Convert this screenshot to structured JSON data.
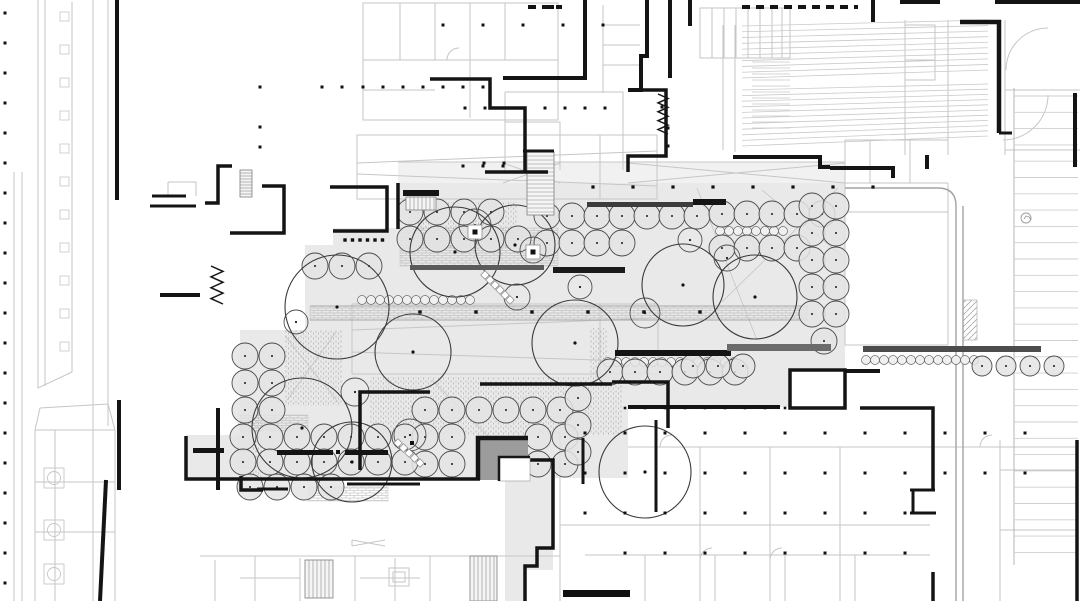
{
  "meta": {
    "drawing_type": "architectural-site-plan",
    "canvas_w": 1080,
    "canvas_h": 601
  },
  "palette": {
    "background": "#ffffff",
    "plaza_fill": "#e9e9e9",
    "corridor_fill": "#f1f1f1",
    "light_line": "#c6c6c6",
    "mid_line": "#a3a3a3",
    "dark_line": "#141414",
    "tree_line": "#4a4a4a",
    "tree_fill": "#e4e4e4",
    "shrub_line": "#6a6a6a",
    "shrub_fill": "#f0f0f0",
    "big_tree_line": "#3a3a3a",
    "roof_gray": "#9c9c9c",
    "hatch_line": "#a0a0a0",
    "bench_dark": "#141414",
    "bench_gray": "#6b6b6b"
  },
  "plan": {
    "plaza_polygon": "398,183 845,183 845,368 790,368 790,407 628,407 628,478 553,478 553,570 525,570 525,601 505,601 505,480 240,480 240,330 305,330 305,245 333,245 333,228 398,228",
    "plaza_extra_rect": [
      186,
      435,
      54,
      45
    ],
    "corridor_rect": [
      398,
      162,
      447,
      21
    ],
    "gray_square": [
      478,
      438,
      50,
      42
    ],
    "white_inset": [
      499,
      457,
      31,
      24
    ],
    "inset_border": "M499,481 V457 H530",
    "square_border": "M478,480 V438 H528",
    "band_lines": "M310,306 H808 M310,320 H808",
    "brick_rects": [
      [
        400,
        228,
        158,
        38
      ],
      [
        310,
        306,
        498,
        14
      ],
      [
        240,
        415,
        68,
        16
      ],
      [
        308,
        487,
        80,
        14
      ]
    ],
    "stipple_rects": [
      [
        285,
        330,
        58,
        76
      ],
      [
        370,
        377,
        252,
        58
      ],
      [
        590,
        328,
        18,
        52
      ],
      [
        237,
        400,
        26,
        82
      ],
      [
        405,
        202,
        112,
        46
      ]
    ],
    "diag_rects": [
      [
        963,
        300,
        14,
        40
      ]
    ],
    "wall_paths": [
      [
        "M117,0 V200",
        4
      ],
      [
        "M585,0 V78 H503",
        4
      ],
      [
        "M430,79 H490 V108 H525 V172",
        3.5
      ],
      [
        "M485,172 H548",
        3.5
      ],
      [
        "M647,0 V56 H641 V90 H628",
        4
      ],
      [
        "M670,0 V78",
        4
      ],
      [
        "M690,0 V26",
        4
      ],
      [
        "M628,90 H666 V156 H628 V172",
        3.5
      ],
      [
        "M960,22 H999 V133",
        4.5
      ],
      [
        "M999,133 H1012",
        3
      ],
      [
        "M873,0 V22",
        4
      ],
      [
        "M733,157 H820 V167 H830",
        4
      ],
      [
        "M830,168 H893 V178",
        4
      ],
      [
        "M927,155 V169",
        4
      ],
      [
        "M1075,93 V167",
        4
      ],
      [
        "M995,2 H1080",
        4
      ],
      [
        "M900,2 H940",
        4
      ],
      [
        "M205,203 H218 V166 H232",
        3.5
      ],
      [
        "M230,233 H284 V186 H262",
        3.5
      ],
      [
        "M330,187 H387 V231 H333",
        3.5
      ],
      [
        "M152,196 H186",
        3
      ],
      [
        "M150,206 H196",
        3
      ],
      [
        "M160,295 H200",
        4
      ],
      [
        "M398,183 V229",
        3.5
      ],
      [
        "M523,151 H554",
        3
      ],
      [
        "M360,470 V392 H430",
        3.5
      ],
      [
        "M480,384 H612",
        3.5
      ],
      [
        "M612,382 H668 V428",
        3.5
      ],
      [
        "M656,420 V512",
        3
      ],
      [
        "M186,436 V479 H480",
        3.5
      ],
      [
        "M347,484 H420",
        3
      ],
      [
        "M583,438 V484",
        3
      ],
      [
        "M628,407 H780",
        4
      ],
      [
        "M790,408 V370 H845 V408 Z",
        3.5
      ],
      [
        "M845,371 H880",
        4
      ],
      [
        "M860,408 H933 V490",
        3.5
      ],
      [
        "M910,490 H935",
        3
      ],
      [
        "M913,490 V513",
        3
      ],
      [
        "M910,513 H936",
        3
      ],
      [
        "M933,572 V601",
        3.5
      ],
      [
        "M1077,440 V601",
        3.5
      ],
      [
        "M119,400 V490",
        4
      ],
      [
        "M218,408 V490",
        4
      ],
      [
        "M106,480 L100,601",
        4
      ],
      [
        "M241,476 V490 H263",
        3.5
      ],
      [
        "M257,489 H288",
        3
      ],
      [
        "M515,460 H553 V548 H537 V566 H525 V601",
        3.5
      ]
    ],
    "dashed_walls": [
      [
        "M742,7 H858",
        4
      ],
      [
        "M528,7 H562",
        4
      ]
    ],
    "light_paths": [
      "M38,0 V388 L72,372 V2 M45,0 V386",
      "M93,0 V601 M108,0 V426 M14,172 V601 M22,172 V601",
      "M363,3 H558 V120 H363 Z M400,3 V60 M435,3 V60 M470,3 V118 M505,3 V60 M363,60 H558 M363,90 H435",
      "M603,5 V93 M603,25 H640 M603,45 H640 M603,65 H640",
      "M700,8 H790 V58 H700 Z M712,8 V58 M724,8 V58 M736,8 V58 M748,8 V58 M760,8 V58 M772,8 V58 M782,8 V58",
      "M723,25 V150 M735,25 V152",
      "M905,20 V155 M948,20 V155 M905,25 H935 V60 H905 M905,60 H935 V80 H905",
      "M505,92 H623 V170 M505,92 V170 M505,122 H560 V170",
      "M357,135 H657 V199 H357 Z M357,163 L657,151 M357,174 L657,186 M600,135 V199",
      "M352,304 H658 V374 H352 Z M352,330 L658,318 M352,352 L658,362 M600,304 V374",
      "M35,430 H115 V601 M35,430 V601 M40,408 L108,404 M40,408 L35,430 M108,404 L115,430 M55,430 V601 M35,482 H115 M35,532 H115",
      "M200,556 H560 M215,560 V601 M255,556 V601 M300,558 V601 M355,556 V601 M395,558 V601 M430,556 V601 M490,556 V601 M240,578 H300 M360,578 H420",
      "M628,447 H1075 M560,430 V601 M560,525 H930 M700,447 V601 M770,447 V601 M840,447 V601 M1000,440 V601 M1000,470 H1077 M1000,530 H1077 M585,555 H930 M645,555 V601 M715,555 V601 M785,555 V601 M855,555 V601",
      "M845,140 V345 M948,183 V345 M845,183 H948 M845,212 H948 M845,345 H948 M870,140 V183 M910,140 V183 M845,140 H948",
      "M1048,28 A42,42 0 0 0 1006,70 M1048,95 A45,45 0 0 1 1003,140 M1005,90 H1080 M1005,150 H1080 M1005,20 V155",
      "M398,162 H845 M503,163 L560,183 M560,163 L503,183 M628,163 L845,183 M845,163 L628,183",
      "M389,568 H409 V586 H389 Z M393,572 H405 V582 H393 Z M352,540 L385,546 M352,546 L385,540 M352,540 V546",
      "M620,250 a14,14 0 0 1 14,-14 M756,252 a16,16 0 0 0 -16,-16 M700,560 a12,12 0 0 1 12,-12 M770,560 a12,12 0 0 1 12,-12 M980,447 a12,12 0 0 1 12,-12 M660,447 a12,12 0 0 1 12,-12 M447,60 a12,12 0 0 1 12,-12",
      "M168,182 H196 V196 M168,182 V196"
    ],
    "plaza_diagonals": "M697,188 L757,340 M838,188 L722,302 M845,258 L762,190 M285,336 L338,402 M336,332 L287,400 M432,380 L520,468",
    "road_paths": [
      "M845,188 H938 Q956,188 956,206 V601",
      "M963,206 V601"
    ],
    "fans": [
      {
        "p": [
          742,
          26
        ],
        "q": [
          988,
          20
        ],
        "r": [
          742,
          78
        ],
        "s": [
          988,
          70
        ],
        "n": 9
      },
      {
        "p": [
          742,
          90
        ],
        "q": [
          988,
          84
        ],
        "r": [
          742,
          146
        ],
        "s": [
          988,
          136
        ],
        "n": 10
      },
      {
        "p": [
          752,
          62
        ],
        "q": [
          790,
          62
        ],
        "r": [
          752,
          128
        ],
        "s": [
          790,
          128
        ],
        "n": 11
      }
    ],
    "parking": {
      "stall_x1": 1014,
      "stall_x2": 1078,
      "stall_y0": 96,
      "stall_dy": 16.3,
      "stall_n": 29,
      "edge_path": "M1014,88 V565"
    },
    "parking_icon": {
      "x": 1026,
      "y": 218,
      "r": 5
    },
    "tree_rows": [
      [
        410,
        212,
        4,
        27,
        0,
        13
      ],
      [
        410,
        239,
        5,
        27,
        0,
        13
      ],
      [
        547,
        216,
        7,
        25,
        0,
        13
      ],
      [
        547,
        243,
        4,
        25,
        0,
        13
      ],
      [
        722,
        214,
        5,
        25,
        0,
        13
      ],
      [
        722,
        248,
        4,
        25,
        0,
        13
      ],
      [
        812,
        206,
        2,
        24,
        0,
        13
      ],
      [
        812,
        233,
        4,
        0,
        27,
        13
      ],
      [
        836,
        233,
        4,
        0,
        27,
        13
      ],
      [
        824,
        341,
        1,
        0,
        0,
        13
      ],
      [
        315,
        266,
        3,
        27,
        0,
        13
      ],
      [
        245,
        356,
        2,
        27,
        0,
        13
      ],
      [
        245,
        383,
        2,
        27,
        0,
        13
      ],
      [
        245,
        410,
        2,
        27,
        0,
        13
      ],
      [
        425,
        410,
        6,
        27,
        0,
        13
      ],
      [
        425,
        437,
        2,
        27,
        0,
        13
      ],
      [
        538,
        437,
        2,
        27,
        0,
        13
      ],
      [
        425,
        464,
        2,
        27,
        0,
        13
      ],
      [
        538,
        464,
        2,
        27,
        0,
        13
      ],
      [
        578,
        398,
        3,
        0,
        27,
        13
      ],
      [
        610,
        372,
        6,
        25,
        0,
        13
      ],
      [
        693,
        366,
        3,
        25,
        0,
        12
      ],
      [
        243,
        437,
        7,
        27,
        0,
        13
      ],
      [
        243,
        462,
        7,
        27,
        0,
        13
      ],
      [
        250,
        487,
        4,
        27,
        0,
        13
      ],
      [
        982,
        366,
        4,
        24,
        0,
        10
      ]
    ],
    "shrub_rows": [
      [
        362,
        300,
        13,
        9,
        4.5
      ],
      [
        608,
        362,
        15,
        9,
        4.5
      ],
      [
        720,
        231,
        8,
        9,
        4.5
      ],
      [
        866,
        360,
        13,
        9,
        4.5
      ]
    ],
    "big_trees": [
      [
        337,
        307,
        52
      ],
      [
        455,
        252,
        45
      ],
      [
        515,
        245,
        40
      ],
      [
        575,
        343,
        43
      ],
      [
        683,
        285,
        41
      ],
      [
        755,
        297,
        42
      ],
      [
        302,
        428,
        50
      ],
      [
        352,
        462,
        40
      ],
      [
        413,
        352,
        38
      ],
      [
        645,
        472,
        46
      ]
    ],
    "med_trees": [
      [
        475,
        225,
        16
      ],
      [
        533,
        250,
        13
      ],
      [
        580,
        287,
        12
      ],
      [
        517,
        297,
        13
      ],
      [
        645,
        313,
        15
      ],
      [
        727,
        258,
        13
      ],
      [
        410,
        435,
        16
      ],
      [
        296,
        322,
        12
      ],
      [
        355,
        392,
        14
      ],
      [
        690,
        240,
        12
      ]
    ],
    "tree_pits": [
      [
        475,
        232
      ],
      [
        533,
        252
      ]
    ],
    "benches": [
      [
        410,
        265,
        134,
        5,
        "#5a5a5a"
      ],
      [
        553,
        267,
        72,
        6,
        "#1b1b1b"
      ],
      [
        587,
        202,
        106,
        5,
        "#3c3c3c"
      ],
      [
        693,
        199,
        33,
        6,
        "#141414"
      ],
      [
        615,
        350,
        116,
        6,
        "#141414"
      ],
      [
        727,
        344,
        104,
        7,
        "#6b6b6b"
      ],
      [
        863,
        346,
        178,
        6,
        "#4c4c4c"
      ],
      [
        277,
        450,
        56,
        5,
        "#141414"
      ],
      [
        345,
        450,
        43,
        5,
        "#141414"
      ],
      [
        193,
        448,
        31,
        5,
        "#141414"
      ],
      [
        563,
        590,
        67,
        7,
        "#111111"
      ],
      [
        403,
        190,
        36,
        6,
        "#141414"
      ]
    ],
    "ladders": [
      [
        240,
        170,
        12,
        27,
        3,
        "h"
      ],
      [
        527,
        152,
        27,
        63,
        4,
        "h"
      ],
      [
        406,
        197,
        30,
        13,
        4,
        "v"
      ],
      [
        305,
        560,
        28,
        38,
        4,
        "v"
      ],
      [
        470,
        556,
        27,
        45,
        4,
        "v"
      ]
    ],
    "diag_ladders": [
      [
        485,
        275,
        510,
        300,
        6
      ],
      [
        398,
        443,
        420,
        463,
        5
      ]
    ],
    "zigzags": [
      [
        217,
        266,
        304,
        6,
        7
      ],
      [
        663,
        94,
        134,
        5,
        9
      ]
    ],
    "dot_rows": [
      [
        443,
        25,
        5,
        40,
        0,
        3
      ],
      [
        363,
        87,
        7,
        20,
        0,
        3
      ],
      [
        465,
        108,
        2,
        20,
        0,
        3
      ],
      [
        545,
        108,
        4,
        20,
        0,
        3
      ],
      [
        463,
        166,
        3,
        20,
        0,
        3
      ],
      [
        260,
        87,
        1,
        0,
        0,
        3
      ],
      [
        322,
        87,
        2,
        20,
        0,
        3
      ],
      [
        260,
        127,
        1,
        0,
        0,
        3
      ],
      [
        260,
        147,
        1,
        0,
        0,
        3
      ],
      [
        593,
        187,
        8,
        40,
        0,
        3.2
      ],
      [
        625,
        408,
        9,
        20,
        0,
        2.6
      ],
      [
        585,
        433,
        12,
        40,
        0,
        3
      ],
      [
        585,
        473,
        12,
        40,
        0,
        3
      ],
      [
        585,
        513,
        9,
        40,
        0,
        3
      ],
      [
        625,
        553,
        8,
        40,
        0,
        3
      ],
      [
        345,
        240,
        6,
        7.5,
        0,
        3.4
      ],
      [
        420,
        312,
        6,
        56,
        0,
        3.4
      ],
      [
        5,
        13,
        20,
        0,
        30,
        3
      ]
    ],
    "dots": [
      [
        662,
        107,
        3
      ],
      [
        668,
        128,
        3
      ],
      [
        668,
        146,
        3
      ],
      [
        533,
        7,
        4
      ],
      [
        552,
        7,
        4
      ],
      [
        338,
        452,
        4
      ],
      [
        412,
        443,
        4
      ],
      [
        484,
        163,
        3
      ],
      [
        504,
        163,
        3
      ]
    ],
    "fixtures": [
      [
        44,
        468
      ],
      [
        44,
        520
      ],
      [
        44,
        564
      ]
    ],
    "window_col": {
      "x": 60,
      "y0": 12,
      "n": 11,
      "dy": 33,
      "s": 9
    }
  }
}
